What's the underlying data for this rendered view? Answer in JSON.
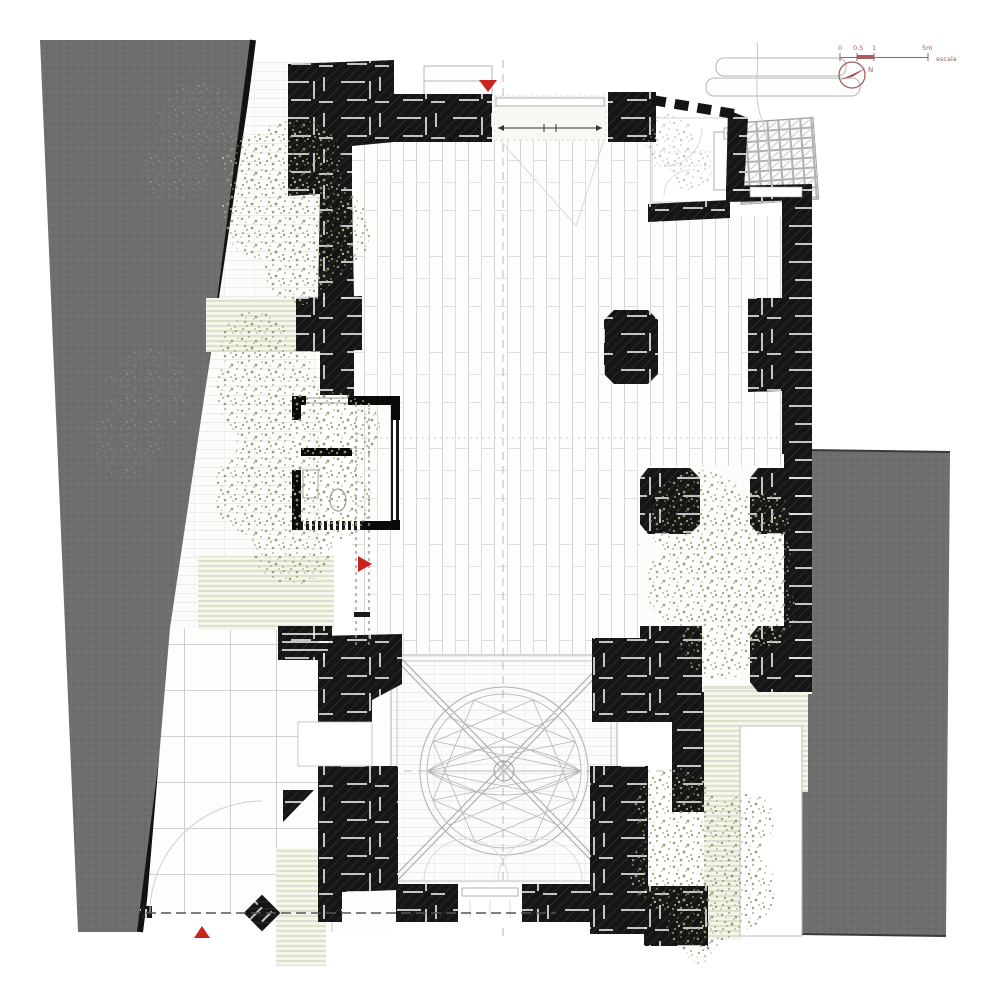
{
  "drawing": {
    "annotations": {
      "scale_bar": {
        "tick_labels": [
          "0",
          "0.5",
          "1",
          "5m"
        ],
        "caption": "escala"
      },
      "north_arrow": {
        "label": "N"
      }
    },
    "colors": {
      "paper": "#ffffff",
      "neighbor_building_gray": "#6e6e6e",
      "stone_wall_black": "#151515",
      "new_construction_black": "#0a0a0a",
      "vegetation_olive": "#8f9e70",
      "vegetation_light": "#b3bf95",
      "paving_line_gray": "#d6d6d6",
      "dome_projection_gray": "#b0b0b0",
      "entrance_marker_red": "#c9231c",
      "annotation_maroon": "#a4605c"
    },
    "icons": [
      "north-arrow-icon",
      "scale-bar",
      "entrance-marker-north",
      "entrance-marker-west",
      "entrance-marker-south-gate"
    ]
  }
}
